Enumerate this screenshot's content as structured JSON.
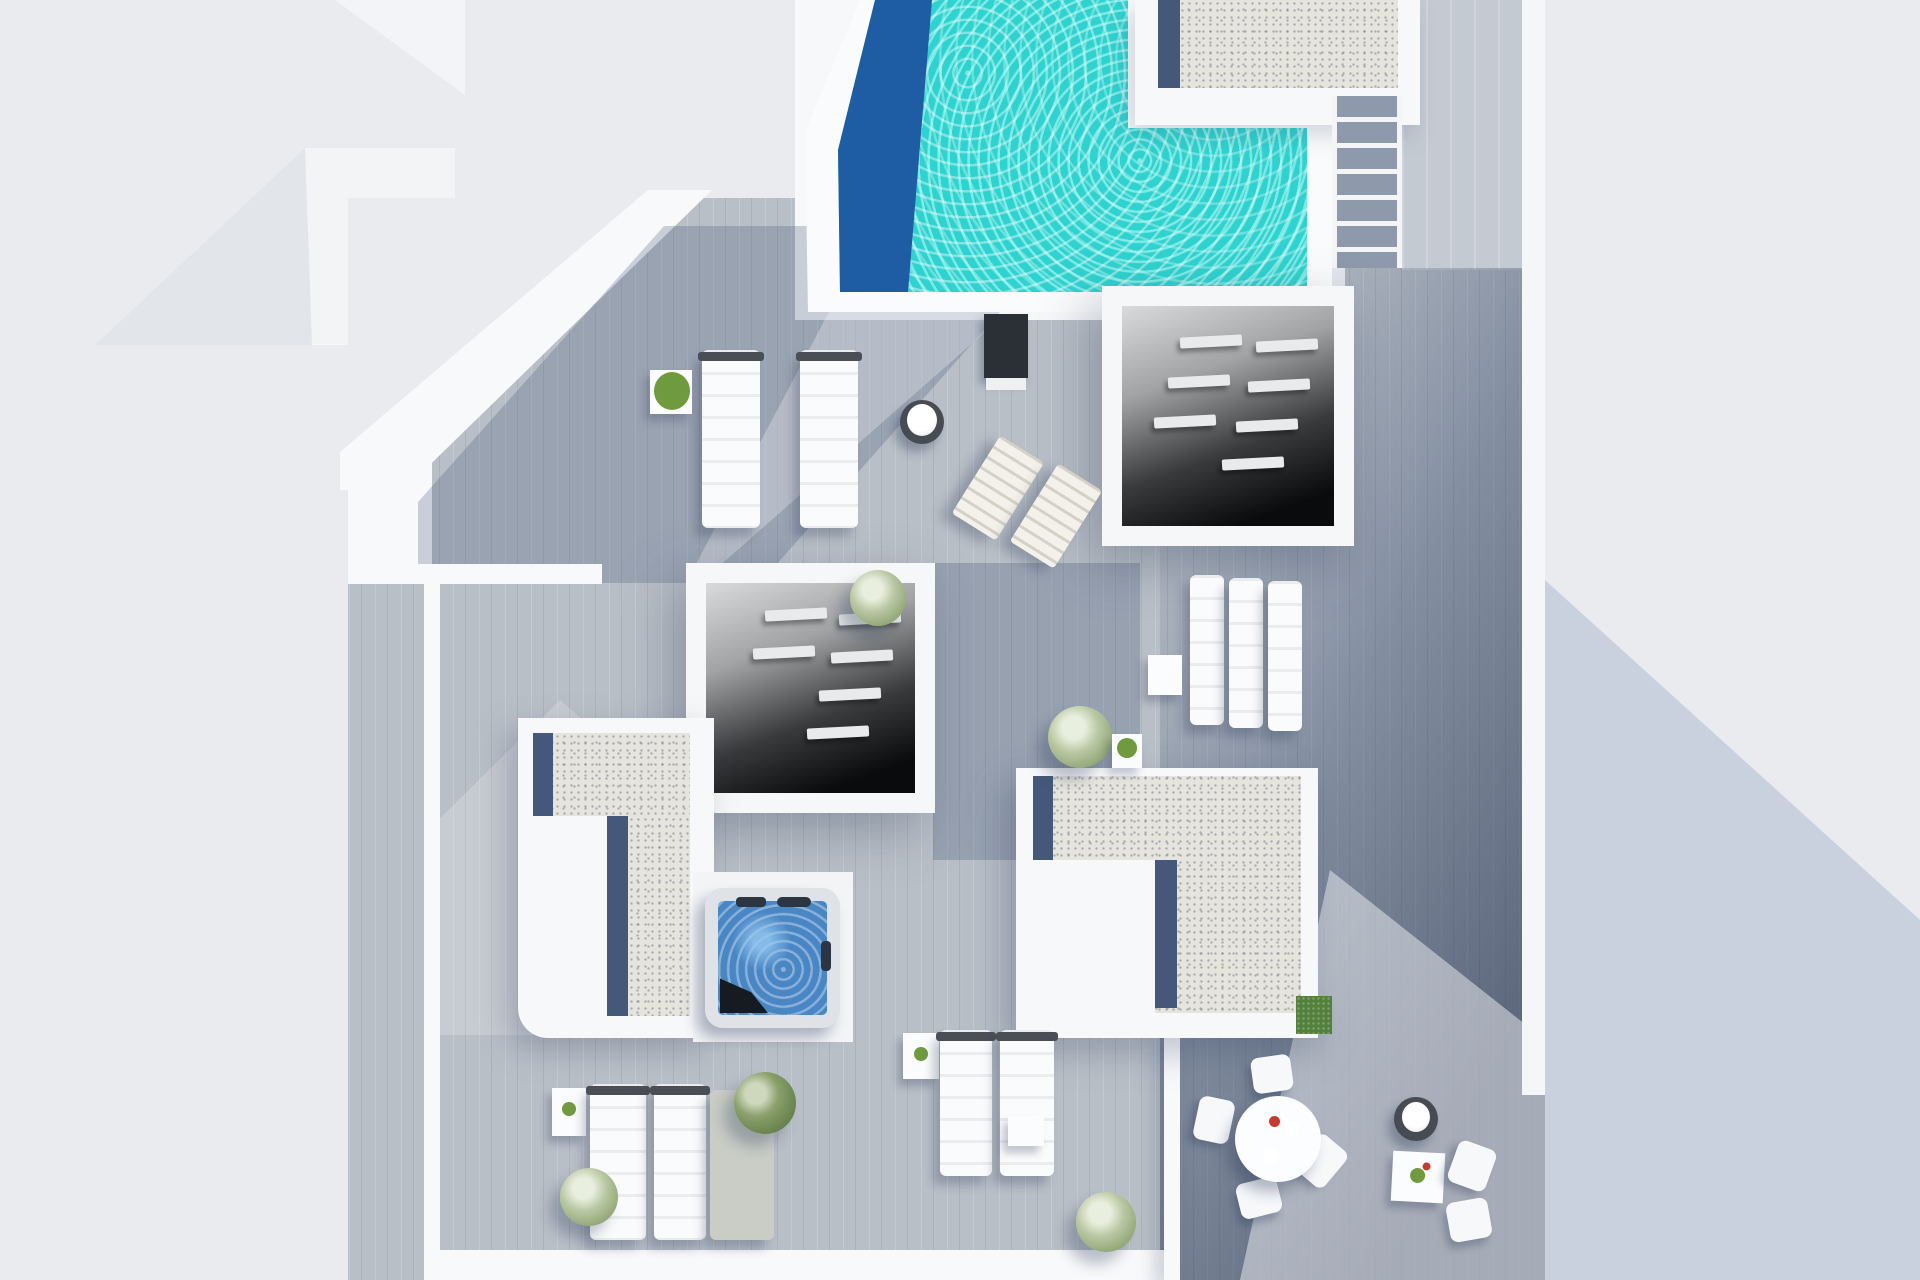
{
  "scene": {
    "title": "Top-down 3D architectural render of a penthouse rooftop terrace with pool",
    "type": "architectural-visualization",
    "visible_text": "none",
    "orientation": "plan view (bird's eye)",
    "lighting": "sun from upper right, long blue-grey shadows cast down-left"
  },
  "palette": {
    "background": "#e9ebef",
    "deck_wood": "#b9bfc7",
    "deck_wood_sunlit": "#c4cad2",
    "white_walls": "#f8f9fb",
    "pool_turquoise": "#2ed3cf",
    "pool_deep_blue": "#1e5ca3",
    "gravel": "#e6e5dd",
    "gravel_shadow_strip": "#44597a",
    "void_interior_dark": "#0a0b0c",
    "jacuzzi_water": "#4886c4",
    "grass_patch": "#53803a",
    "shadow_tint": "rgba(45,65,100,0.4)"
  },
  "areas": {
    "pool": {
      "label": "L-shaped swimming pool with ripple caustics",
      "water_color": "#2ed3cf",
      "deep_end_color": "#1e5ca3",
      "position": "top center"
    },
    "gravel_roof_top_right": {
      "label": "gravel roof block beside pool",
      "position": "top right of pool"
    },
    "stairs": {
      "label": "wooden stair flight with white nosings",
      "steps_visible": 7,
      "position": "top right"
    },
    "skylight_void_1": {
      "label": "open light well with louvre slats over dark room",
      "position": "right of center, below pool"
    },
    "skylight_void_2": {
      "label": "open light well with louvre slats over dark room",
      "position": "center of terrace"
    },
    "gravel_roof_left": {
      "label": "L-shaped gravel roof strip",
      "position": "center left"
    },
    "gravel_roof_big": {
      "label": "large gravel roof with notched corner and grass patch",
      "position": "center right"
    },
    "jacuzzi": {
      "label": "square hot tub with headrests and folded dark cover",
      "position": "center"
    },
    "neighbour_roofs": {
      "label": "pitched neighbour roofs",
      "position": "top left background"
    },
    "shadow_building": {
      "label": "large diagonal shadow of adjacent tall building",
      "position": "right side"
    }
  },
  "furniture": {
    "padded_loungers_top": 2,
    "towel_tables_round": 2,
    "reclined_deck_chairs": 2,
    "loungers_mid_right": 3,
    "loungers_bottom_left": 3,
    "loungers_bottom_mid": 2,
    "side_tables": 4,
    "dining_set": {
      "table": "round white table",
      "chairs": 4,
      "accessories": [
        "red cup",
        "white tableware"
      ]
    },
    "bistro_set": {
      "table": 1,
      "chairs": 2
    },
    "plants": 7,
    "dark_pool_panel": 1
  }
}
